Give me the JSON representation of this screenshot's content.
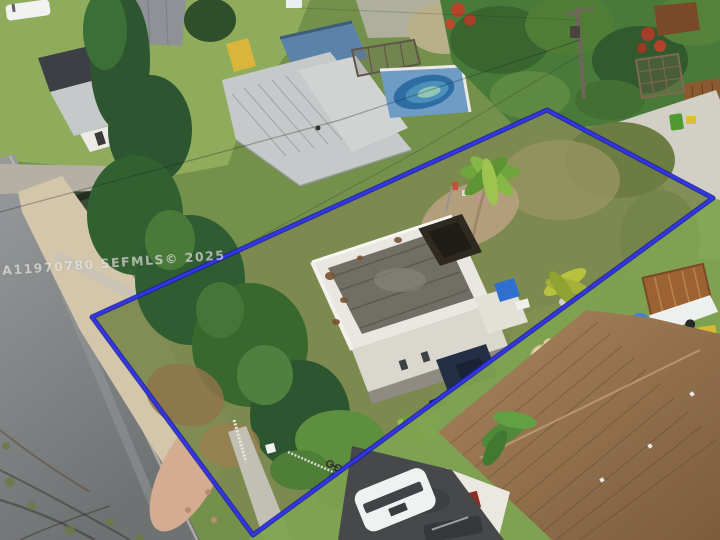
{
  "image": {
    "type": "aerial-drone-photo",
    "subject": "residential lot with storm-damaged white house outlined by blue property boundary",
    "width_px": 720,
    "height_px": 540
  },
  "watermark": {
    "text": "A11970780 SEFMLS© 2025"
  },
  "boundary": {
    "points": "92,317 547,110 713,198 253,535",
    "color": "#3336e8",
    "underlay_color": "#1a1d99"
  },
  "colors": {
    "grass_base": "#74914c",
    "lawn_bright": "#8fac5c",
    "neighbor_lawn": "#7ea351",
    "lot_scrub": "#7c8a4f",
    "pine_dark": "#2c5530",
    "canopy_mid": "#4a7a3a",
    "road": "#8d9091",
    "sand": "#d3c6aa",
    "debris_pink": "#d4ac92",
    "pool_water": "#2e6da4",
    "pool_deck": "#6f9cc4",
    "blue_shed": "#5b82a8",
    "subject_house_walls": "#e9e7e1",
    "subject_roof_deck": "#716e66",
    "roof_hole": "#2e2921",
    "tarp_blue": "#2f6fd0",
    "tarp_navy": "#232f45",
    "brown_roof": "#97744e",
    "trailer_rust": "#9c6233",
    "asphalt_driveway": "#46484a",
    "white_vehicle": "#f0f1f1",
    "red_bloom": "#c04028",
    "green_bin": "#4f9b2f",
    "yellow_machine": "#d6b92e"
  }
}
